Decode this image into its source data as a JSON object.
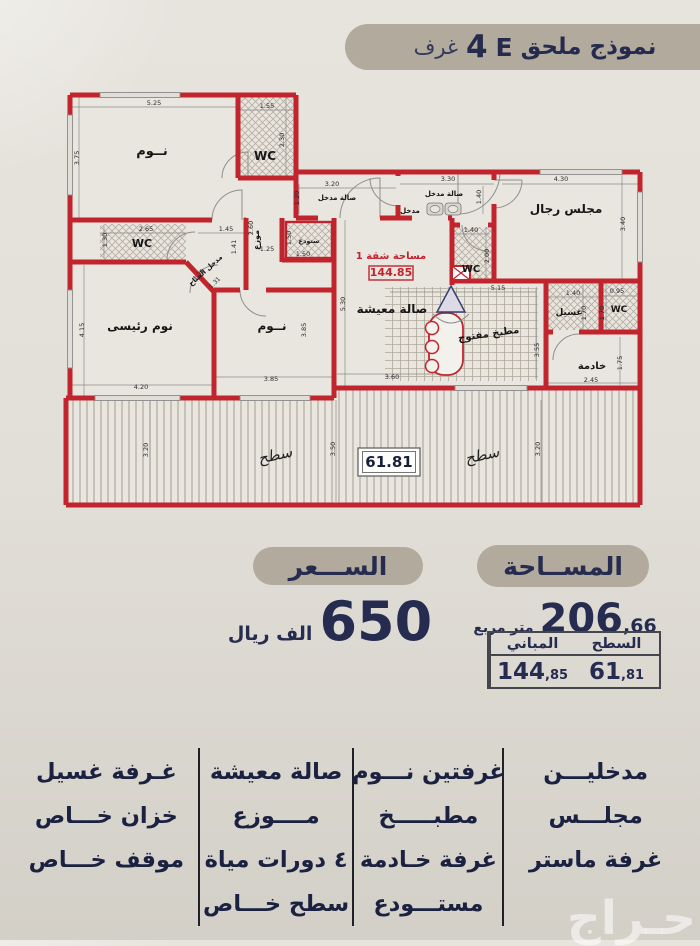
{
  "colors": {
    "wall_red": "#c2242e",
    "navy": "#262c50",
    "banner_bg": "#b1aa9d"
  },
  "banner": {
    "prefix": "نموذج ملحق",
    "model": "E",
    "count": "4",
    "suffix": "غرف"
  },
  "price": {
    "header": "الســـعر",
    "amount": "650",
    "unit": "الف ريال"
  },
  "area": {
    "header": "المســاحة",
    "total_int": "206",
    "total_dec": ",66",
    "total_unit": "متر مربع",
    "table": {
      "col_surface": "السطح",
      "col_building": "المباني",
      "surface_int": "61",
      "surface_dec": ",81",
      "building_int": "144",
      "building_dec": ",85"
    }
  },
  "features": {
    "columns": [
      {
        "items": [
          "مدخليـــن",
          "مجلـــس",
          "غرفة ماستر"
        ]
      },
      {
        "items": [
          "غرفتين نـــوم",
          "مطبـــــخ",
          "غرفة خـادمة",
          "مستـــودع"
        ]
      },
      {
        "items": [
          "صالة معيشة",
          "مــــوزع",
          "٤ دورات مياة",
          "سطح خـــاص"
        ]
      },
      {
        "items": [
          "غـرفة غسيل",
          "خزان خـــاص",
          "موقف خـــاص"
        ]
      }
    ]
  },
  "watermark": "حـراج",
  "floorplan": {
    "labels": [
      {
        "t": "نــوم",
        "x": 152,
        "y": 155,
        "r": 0,
        "s": 13,
        "c": "fp-room"
      },
      {
        "t": "WC",
        "x": 265,
        "y": 160,
        "r": 0,
        "s": 12,
        "c": "fp-room"
      },
      {
        "t": "صالة مدخل",
        "x": 337,
        "y": 200,
        "r": 0,
        "s": 7,
        "c": "fp-room"
      },
      {
        "t": "صالة مدخل",
        "x": 444,
        "y": 196,
        "r": 0,
        "s": 7,
        "c": "fp-room"
      },
      {
        "t": "مدخل",
        "x": 410,
        "y": 213,
        "r": 0,
        "s": 7,
        "c": "fp-room"
      },
      {
        "t": "مجلس رجال",
        "x": 566,
        "y": 213,
        "r": 0,
        "s": 12,
        "c": "fp-room"
      },
      {
        "t": "WC",
        "x": 471,
        "y": 272,
        "r": 0,
        "s": 10,
        "c": "fp-room"
      },
      {
        "t": "موزع",
        "x": 259,
        "y": 240,
        "r": -90,
        "s": 8,
        "c": "fp-room"
      },
      {
        "t": "ستودع",
        "x": 309,
        "y": 243,
        "r": 0,
        "s": 6.5,
        "c": "fp-room"
      },
      {
        "t": "مدخل الجناح",
        "x": 207,
        "y": 272,
        "r": -42,
        "s": 7,
        "c": "fp-room"
      },
      {
        "t": "WC",
        "x": 142,
        "y": 247,
        "r": 0,
        "s": 11,
        "c": "fp-room"
      },
      {
        "t": "نوم رئيسى",
        "x": 140,
        "y": 330,
        "r": 0,
        "s": 12,
        "c": "fp-room"
      },
      {
        "t": "نــوم",
        "x": 272,
        "y": 330,
        "r": 0,
        "s": 12,
        "c": "fp-room"
      },
      {
        "t": "صالة معيشة",
        "x": 392,
        "y": 313,
        "r": 0,
        "s": 12,
        "c": "fp-room"
      },
      {
        "t": "مطبخ مفتوح",
        "x": 489,
        "y": 337,
        "r": -8,
        "s": 10,
        "c": "fp-room"
      },
      {
        "t": "غسيل",
        "x": 569,
        "y": 315,
        "r": 0,
        "s": 9,
        "c": "fp-room"
      },
      {
        "t": "WC",
        "x": 619,
        "y": 312,
        "r": 0,
        "s": 9,
        "c": "fp-room"
      },
      {
        "t": "خادمة",
        "x": 592,
        "y": 369,
        "r": 0,
        "s": 10,
        "c": "fp-room"
      },
      {
        "t": "سطح",
        "x": 276,
        "y": 460,
        "r": -12,
        "s": 15,
        "c": "fp-roof"
      },
      {
        "t": "سطح",
        "x": 483,
        "y": 460,
        "r": -12,
        "s": 15,
        "c": "fp-roof"
      },
      {
        "t": "مساحة شقة 1",
        "x": 391,
        "y": 259,
        "r": 0,
        "s": 10,
        "c": "fp-red"
      },
      {
        "t": "144.85",
        "x": 391,
        "y": 276,
        "r": 0,
        "s": 11,
        "c": "fp-red"
      },
      {
        "t": "61.81",
        "x": 389,
        "y": 467,
        "r": 0,
        "s": 15,
        "c": "fp-box"
      },
      {
        "t": "5.25",
        "x": 154,
        "y": 105,
        "r": 0,
        "s": 6.5,
        "c": "fp-dim"
      },
      {
        "t": "3.75",
        "x": 79,
        "y": 158,
        "r": -90,
        "s": 6.5,
        "c": "fp-dim"
      },
      {
        "t": "1.55",
        "x": 267,
        "y": 108,
        "r": 0,
        "s": 6.5,
        "c": "fp-dim"
      },
      {
        "t": "2.30",
        "x": 284,
        "y": 140,
        "r": -90,
        "s": 6.5,
        "c": "fp-dim"
      },
      {
        "t": "3.20",
        "x": 332,
        "y": 186,
        "r": 0,
        "s": 6.5,
        "c": "fp-dim"
      },
      {
        "t": "1.20",
        "x": 299,
        "y": 198,
        "r": -90,
        "s": 6.5,
        "c": "fp-dim"
      },
      {
        "t": "3.30",
        "x": 448,
        "y": 181,
        "r": 0,
        "s": 6.5,
        "c": "fp-dim"
      },
      {
        "t": "1.40",
        "x": 481,
        "y": 197,
        "r": -90,
        "s": 6.5,
        "c": "fp-dim"
      },
      {
        "t": "4.30",
        "x": 561,
        "y": 181,
        "r": 0,
        "s": 6.5,
        "c": "fp-dim"
      },
      {
        "t": "3.40",
        "x": 625,
        "y": 224,
        "r": -90,
        "s": 6.5,
        "c": "fp-dim"
      },
      {
        "t": "2.65",
        "x": 146,
        "y": 231,
        "r": 0,
        "s": 6.5,
        "c": "fp-dim"
      },
      {
        "t": "1.30",
        "x": 107,
        "y": 240,
        "r": -90,
        "s": 6.5,
        "c": "fp-dim"
      },
      {
        "t": "1.45",
        "x": 226,
        "y": 231,
        "r": 0,
        "s": 6.5,
        "c": "fp-dim"
      },
      {
        "t": "1.41",
        "x": 236,
        "y": 247,
        "r": -90,
        "s": 6.5,
        "c": "fp-dim"
      },
      {
        "t": "1.31",
        "x": 200,
        "y": 276,
        "r": -45,
        "s": 6,
        "c": "fp-dim"
      },
      {
        "t": "1.31",
        "x": 216,
        "y": 284,
        "r": -45,
        "s": 6,
        "c": "fp-dim"
      },
      {
        "t": "2.60",
        "x": 253,
        "y": 228,
        "r": -90,
        "s": 6.5,
        "c": "fp-dim"
      },
      {
        "t": "1.25",
        "x": 267,
        "y": 251,
        "r": 0,
        "s": 6.5,
        "c": "fp-dim"
      },
      {
        "t": "1.50",
        "x": 303,
        "y": 256,
        "r": 0,
        "s": 6.5,
        "c": "fp-dim"
      },
      {
        "t": "1.50",
        "x": 291,
        "y": 238,
        "r": -90,
        "s": 6.5,
        "c": "fp-dim"
      },
      {
        "t": "4.15",
        "x": 84,
        "y": 330,
        "r": -90,
        "s": 6.5,
        "c": "fp-dim"
      },
      {
        "t": "4.20",
        "x": 141,
        "y": 389,
        "r": 0,
        "s": 6.5,
        "c": "fp-dim"
      },
      {
        "t": "3.85",
        "x": 271,
        "y": 381,
        "r": 0,
        "s": 6.5,
        "c": "fp-dim"
      },
      {
        "t": "3.85",
        "x": 306,
        "y": 330,
        "r": -90,
        "s": 6.5,
        "c": "fp-dim"
      },
      {
        "t": "5.30",
        "x": 345,
        "y": 304,
        "r": -90,
        "s": 6.5,
        "c": "fp-dim"
      },
      {
        "t": "3.60",
        "x": 392,
        "y": 379,
        "r": 0,
        "s": 6.5,
        "c": "fp-dim"
      },
      {
        "t": "1.40",
        "x": 471,
        "y": 232,
        "r": 0,
        "s": 6.5,
        "c": "fp-dim"
      },
      {
        "t": "2.00",
        "x": 489,
        "y": 256,
        "r": -90,
        "s": 6.5,
        "c": "fp-dim"
      },
      {
        "t": "5.15",
        "x": 498,
        "y": 290,
        "r": 0,
        "s": 6.5,
        "c": "fp-dim"
      },
      {
        "t": "3.55",
        "x": 539,
        "y": 350,
        "r": -90,
        "s": 6.5,
        "c": "fp-dim"
      },
      {
        "t": "1.40",
        "x": 573,
        "y": 295,
        "r": 0,
        "s": 6.5,
        "c": "fp-dim"
      },
      {
        "t": "1.70",
        "x": 586,
        "y": 313,
        "r": -90,
        "s": 6.5,
        "c": "fp-dim"
      },
      {
        "t": "0.95",
        "x": 617,
        "y": 293,
        "r": 0,
        "s": 6.5,
        "c": "fp-dim"
      },
      {
        "t": "1.70",
        "x": 604,
        "y": 313,
        "r": -90,
        "s": 6.5,
        "c": "fp-dim"
      },
      {
        "t": "2.45",
        "x": 591,
        "y": 382,
        "r": 0,
        "s": 6.5,
        "c": "fp-dim"
      },
      {
        "t": "1.75",
        "x": 622,
        "y": 363,
        "r": -90,
        "s": 6.5,
        "c": "fp-dim"
      },
      {
        "t": "3.20",
        "x": 148,
        "y": 450,
        "r": -90,
        "s": 6.5,
        "c": "fp-dim"
      },
      {
        "t": "3.50",
        "x": 335,
        "y": 449,
        "r": -90,
        "s": 6.5,
        "c": "fp-dim"
      },
      {
        "t": "3.20",
        "x": 540,
        "y": 449,
        "r": -90,
        "s": 6.5,
        "c": "fp-dim"
      }
    ]
  }
}
